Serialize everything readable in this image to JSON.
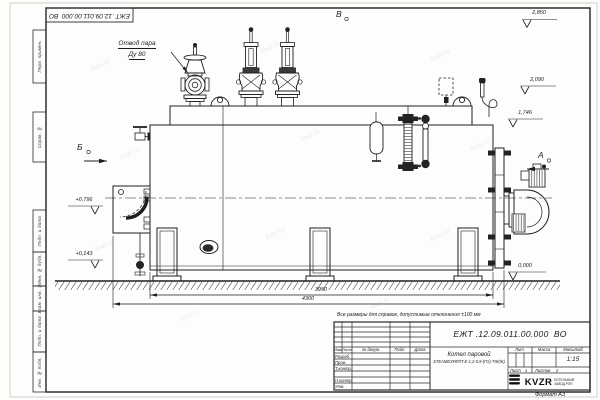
{
  "sheet": {
    "corner_doc_number": "ЕЖТ .12.09.011.00.000  ВО",
    "format_label": "Формат А3",
    "watermark": "kvzr.ru",
    "side_column": [
      "Перв. примен.",
      "Справ. №",
      "Подп. и дата",
      "Инв. № дубл.",
      "Взам. инв. №",
      "Подп. и дата",
      "Инв. № подл."
    ]
  },
  "drawing": {
    "callout_steam_line1": "Отвод пара",
    "callout_steam_line2": "Ду 80",
    "view_v_top": "В",
    "view_b_left": "Б",
    "view_a_right": "А",
    "elev_2850": "2,850",
    "elev_2090": "2,090",
    "elev_1746": "1,746",
    "elev_0000": "0,000",
    "elev_0796": "+0,796",
    "elev_0143": "+0,143",
    "dim_3950": "3950",
    "dim_4300": "4300",
    "note": "Все размеры для справок, допустимые отклонения ±100 мм"
  },
  "title_block": {
    "doc_number_full": "ЕЖТ .12.09.011.00.000  ВО",
    "product_name_line1": "Котел паровой",
    "product_name_line2": "STEAMEXPERT-Е-1,2-0,9-(ГО)-ТЖ(Ж)",
    "col_izm": "Изм.",
    "col_list": "Лист",
    "col_doc": "№ докум.",
    "col_sign": "Подп.",
    "col_date": "Дата",
    "row_developed": "Разраб.",
    "row_checked": "Пров.",
    "row_tcontrol": "Т.контр.",
    "row_ncontrol": "Н.контр.",
    "row_approved": "Утв.",
    "lit_label": "Лит.",
    "mass_label": "Масса",
    "scale_label": "Масштаб",
    "scale_value": "1:15",
    "sheet_label": "Лист",
    "sheet_value": "1",
    "sheets_label": "Листов",
    "sheets_value": "2",
    "logo_text": "KVZR",
    "logo_caption1": "КОТЕЛЬНЫЙ",
    "logo_caption2": "ЗАВОД РЭП"
  }
}
